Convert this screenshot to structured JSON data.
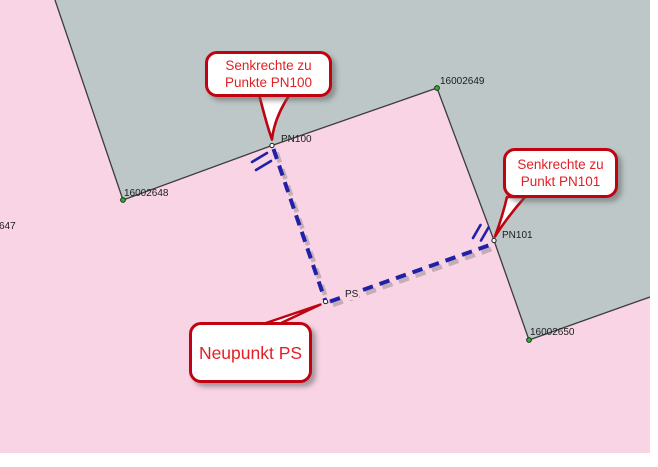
{
  "app_context": "map-view-perpendicular-construction",
  "map": {
    "colors": {
      "background_pink": "#F8D4E4",
      "parcel_gray": "#BDC7C7",
      "boundary_line": "#3C3C3C",
      "construction_blue": "#2121A8",
      "construction_shadow": "#6E6E6E",
      "point_green_fill": "#3DA53D",
      "point_green_stroke": "#0F3D0F",
      "point_white_fill": "#FFFFFF",
      "callout_border_red": "#C00311",
      "callout_text_red": "#E02125",
      "callout_fill": "#FFFFFF"
    },
    "point_labels": {
      "p647": "647",
      "p16002648": "16002648",
      "p16002649": "16002649",
      "p16002650": "16002650",
      "pn100": "PN100",
      "pn101": "PN101",
      "ps": "PS"
    },
    "callouts": {
      "pn100": {
        "line1": "Senkrechte zu",
        "line2": "Punkte PN100"
      },
      "pn101": {
        "line1": "Senkrechte zu",
        "line2": "Punkt PN101"
      },
      "ps": {
        "line1": "Neupunkt PS"
      }
    }
  }
}
